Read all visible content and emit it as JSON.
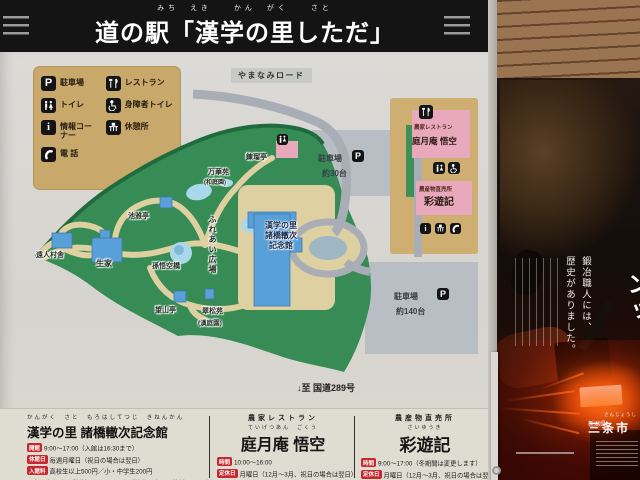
{
  "header": {
    "furigana": "みち　えき　　かん　がく　　さと",
    "title": "道の駅「漢学の里しただ」"
  },
  "legend": {
    "items": [
      {
        "label": "駐車場",
        "glyph": "P"
      },
      {
        "label": "レストラン"
      },
      {
        "label": "トイレ"
      },
      {
        "label": "身障者トイレ"
      },
      {
        "label": "情報コーナー",
        "glyph": "i"
      },
      {
        "label": "休憩所"
      },
      {
        "label": "電 話"
      }
    ]
  },
  "map": {
    "road_label": "やまなみロード",
    "sites": {
      "rengatei": "錬瑠亭",
      "bankaen": "万華苑",
      "bankaen_note": "(和庭園)",
      "chigatei": "池雅亭",
      "enjin_sonsha": "遠人村舎",
      "seika": "生家",
      "songokubashi": "孫悟空橋",
      "bozantei": "望山亭",
      "suishoen": "翠松苑",
      "suishoen_note": "(漢庭園)",
      "fureai_hiroba": "ふれあい広場"
    },
    "building": {
      "line1": "漢学の里",
      "line2": "諸橋轍次",
      "line3": "記念館"
    },
    "parking_top": {
      "label": "駐車場",
      "glyph": "P",
      "capacity": "約30台"
    },
    "parking_bottom": {
      "label": "駐車場",
      "glyph": "P",
      "capacity": "約140台"
    },
    "panel": {
      "restaurant_type": "農家レストラン",
      "restaurant_name": "庭月庵 悟空",
      "shop_type": "農産物直売所",
      "shop_name": "彩遊記",
      "info_glyph": "i"
    },
    "route_note": "↓至 国道289号"
  },
  "info_columns": [
    {
      "furigana": "かんがく　さと　もろはしてつじ　きねんかん",
      "title": "漢学の里 諸橋轍次記念館",
      "rows": [
        {
          "tag": "開館",
          "text": "9:00～17:00（入館は16:30まで）"
        },
        {
          "tag": "休館日",
          "text": "毎週月曜日（祝日の場合は翌日）"
        },
        {
          "tag": "入館料",
          "text": "高校生以上500円／小・中学生200円"
        },
        {
          "tag": "",
          "text": "※庭月庵 悟空、彩遊記のレシートをご持参の方は入館料100円引き"
        }
      ]
    },
    {
      "subtitle": "農家レストラン",
      "furigana": "ていげつあん　ごくう",
      "title": "庭月庵 悟空",
      "rows": [
        {
          "tag": "時間",
          "text": "10:00～16:00"
        },
        {
          "tag": "定休日",
          "text": "月曜日（12月～3月、祝日の場合は翌日）"
        }
      ]
    },
    {
      "subtitle": "農産物直売所",
      "furigana": "さいゆうき",
      "title": "彩遊記",
      "rows": [
        {
          "tag": "時間",
          "text": "9:00～17:00（冬期間は変更します）"
        },
        {
          "tag": "定休日",
          "text": "月曜日（12月～3月、祝日の場合は翌日）"
        }
      ]
    }
  ],
  "poster": {
    "slogan1": "鍛冶職人には、",
    "slogan2": "歴史がありました。",
    "partial_glyphs": "ンッ",
    "prefecture": "新潟県",
    "city": "三条市",
    "city_kana": "さんじょうし"
  },
  "palette": {
    "sign_bg": "#d6d4cf",
    "header_band": "#141414",
    "legend_tan": "#c9a86b",
    "map_green": "#368c54",
    "map_green_edge": "#1f6b3e",
    "path_tan": "#ded0a1",
    "water_blue": "#a8d8ea",
    "building_blue": "#5aa0d8",
    "building_pink": "#e9a9bd",
    "road_gray": "#a9aeb6",
    "parking_gray": "#b9bdc4",
    "accent_red": "#c5282d",
    "poster_glow": "#ff7a20"
  }
}
